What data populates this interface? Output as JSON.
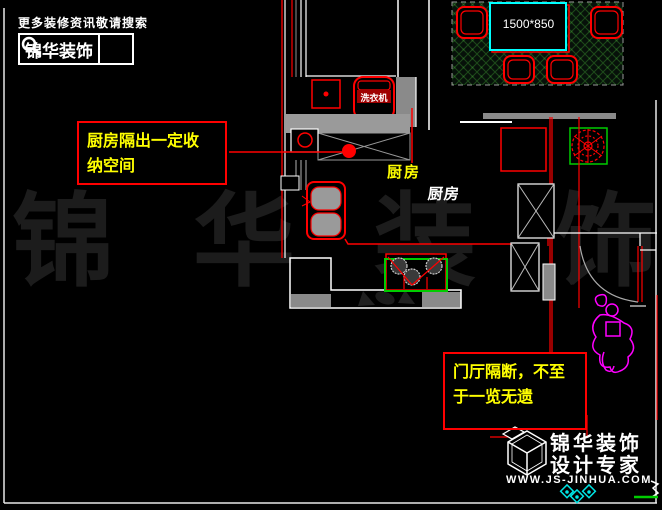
{
  "header": {
    "search_hint": "更多装修资讯敬请搜索",
    "brand": "锦华装饰"
  },
  "annotations": {
    "kitchen_note_line1": "厨房隔出一定收",
    "kitchen_note_line2": "纳空间",
    "hall_note_line1": "门厅隔断，不至",
    "hall_note_line2": "于一览无遗"
  },
  "plan_labels": {
    "table_size": "1500*850",
    "washing_machine": "洗衣机",
    "kitchen_yellow": "厨房",
    "kitchen_white": "厨房"
  },
  "watermark": {
    "text": "锦 华 装 饰",
    "chars": [
      "锦",
      "华",
      "装",
      "饰"
    ]
  },
  "footer": {
    "brand_line1": "锦华装饰",
    "brand_line2": "设计专家",
    "website": "WWW.JS-JINHUA.COM"
  },
  "colors": {
    "annotation_red": "#ff0000",
    "note_yellow": "#ffff00",
    "table_cyan": "#00ffff",
    "stove_green": "#00cc00",
    "figure_magenta": "#ff00ff",
    "wall_gray": "#9a9a9a",
    "carpet_green": "#1d4a1a",
    "watermark_gray": "#1c1c1c"
  }
}
